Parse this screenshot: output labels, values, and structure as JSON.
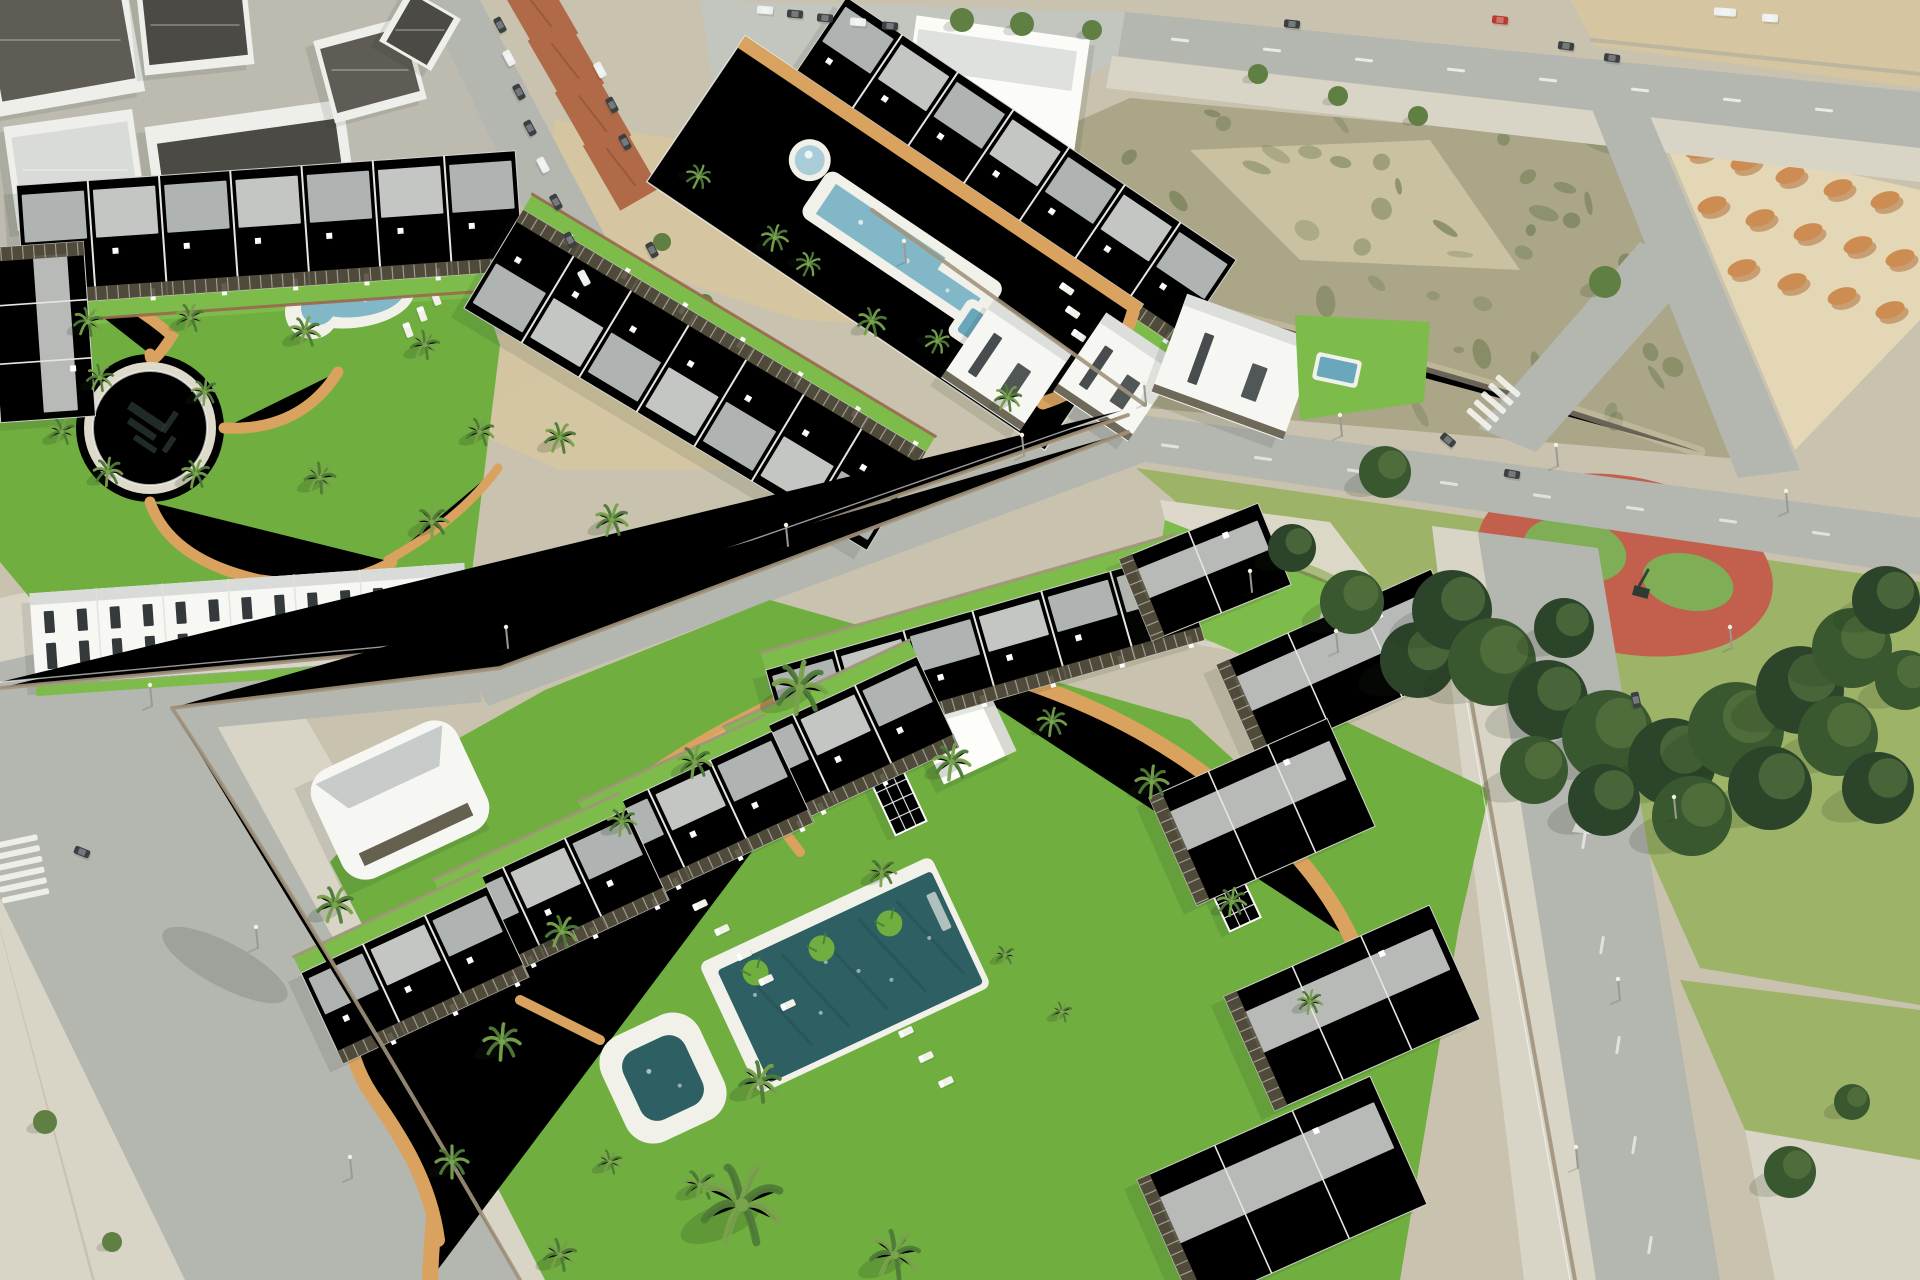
{
  "image": {
    "kind": "aerial-architectural-render",
    "alt": "Aerial 3D render of a new-build residential development: rows of white terraced apartments with dark pergolas around communal lawns, swimming pools and palm trees, next to an old town, a vacant lot with dirt mounds, a tree-filled public park with a circular playground, and surrounding roads with parked cars and crosswalks."
  },
  "palette": {
    "ground": "#c9c2ae",
    "town_ground": "#bdbab0",
    "road": "#b4b6b0",
    "road_light": "#c3c5bf",
    "sidewalk": "#d8d5c7",
    "sand": "#d5c6a1",
    "sand_light": "#e4d7b6",
    "scrub_base": "#aaa687",
    "scrub_green": "#6d7950",
    "dirt_orange": "#cd8c52",
    "dirt_orange_dark": "#b06f3c",
    "lawn": "#6fae3f",
    "lawn_bright": "#7dbc4a",
    "lawn_shadow": "#4d7d2e",
    "park_grass": "#9db368",
    "plaza": "#ddd9cb",
    "tree_dark": "#3a5830",
    "tree_darker": "#2c452a",
    "tree_light": "#5f7f43",
    "palm_green": "#4f7c38",
    "palm_light": "#79a34c",
    "trunk": "#8d7d60",
    "roof_white": "#f6f6f2",
    "roof_gray": "#d8dbd8",
    "roof_slate": "#c2c6c5",
    "roof_dark": "#4b4a45",
    "roof_dark2": "#5e5c54",
    "terracotta": "#b06a48",
    "pergola": "#57503f",
    "window_dark": "#343a3c",
    "pool_deep": "#2e5f62",
    "pool_light": "#82b7c8",
    "pool_mid": "#6aa7bd",
    "pool_pale": "#a9cdd8",
    "deck_white": "#f1f1ea",
    "path_tan": "#d9a25e",
    "path_tan2": "#e5bb7c",
    "stone_wall": "#a2947c",
    "brick_wall": "#9a6750",
    "playground_red": "#c2604d",
    "playground_green": "#7fae57",
    "play_dark": "#2e3b33",
    "car_red": "#b83b30",
    "car_dark": "#3c4043",
    "car_white": "#eceff0",
    "pole_gray": "#9a9a94",
    "shadow": "rgba(30,45,25,0.35)"
  },
  "scene": {
    "setting": "coastal-residential-development",
    "districts": [
      {
        "name": "old-town-district",
        "features": [
          "dark-roof-houses",
          "terracotta-roofs",
          "street-parked-cars",
          "parking-lot"
        ]
      },
      {
        "name": "upper-residential-complex",
        "features": [
          "terraced-townhouse-rows",
          "communal-courtyard",
          "round-fountain-pool",
          "long-lap-pool",
          "plunge-pool",
          "kidney-pool",
          "circular-logo-plaza",
          "palm-trees",
          "tan-paths"
        ]
      },
      {
        "name": "detached-villas",
        "features": [
          "private-pool",
          "private-lawn"
        ]
      },
      {
        "name": "vacant-lot",
        "features": [
          "scrub-vegetation",
          "sandy-patches"
        ]
      },
      {
        "name": "dirt-mound-field",
        "features": [
          "orange-earth-mounds"
        ]
      },
      {
        "name": "public-park",
        "features": [
          "pine-tree-cluster",
          "circular-red-playground",
          "utility-building",
          "paved-plaza"
        ]
      },
      {
        "name": "lower-residential-complex",
        "features": [
          "apartment-rows-with-pergolas",
          "central-lawn",
          "main-swimming-pool",
          "kids-pool",
          "sun-loungers",
          "pool-house-cube",
          "glass-trellises",
          "winding-tan-paths",
          "palm-trees"
        ]
      },
      {
        "name": "road-network",
        "features": [
          "crosswalks",
          "street-lights",
          "lane-markings",
          "moving-cars"
        ]
      }
    ],
    "counts": {
      "main_pool_loungers": 8,
      "courtyard_loungers": 4,
      "glass_trellises": 2,
      "water_features_upper": 4,
      "water_features_lower": 2
    }
  }
}
